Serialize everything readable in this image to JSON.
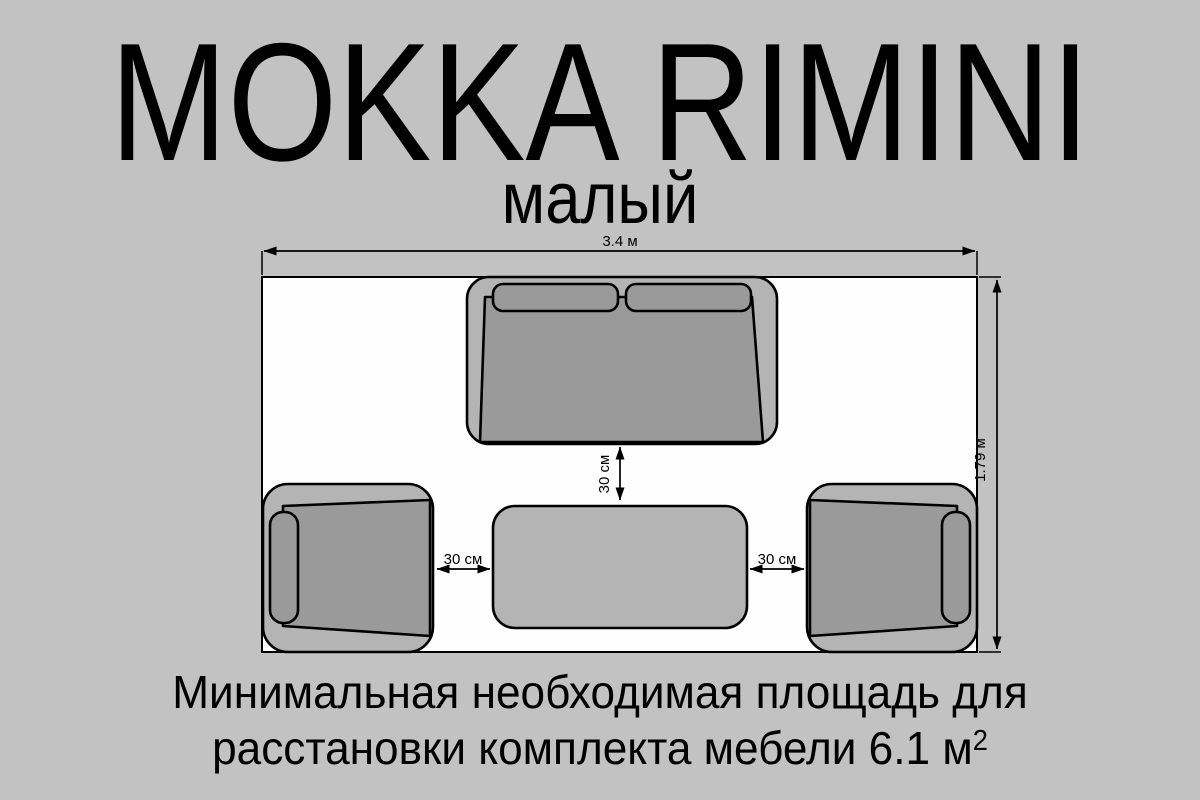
{
  "title": "MOKKA RIMINI",
  "subtitle": "малый",
  "diagram": {
    "dimensions": {
      "room_width_label": "3.4 м",
      "room_height_label": "1.79 м",
      "sofa_to_table_gap_label": "30 см",
      "left_chair_to_table_gap_label": "30 см",
      "table_to_right_chair_gap_label": "30 см"
    },
    "furniture": {
      "sofa": "двухместный диван",
      "left_armchair": "кресло",
      "right_armchair": "кресло",
      "coffee_table": "столик"
    }
  },
  "caption": {
    "line1": "Минимальная необходимая площадь для",
    "line2": "расстановки комплекта мебели 6.1 м",
    "superscript": "2"
  },
  "colors": {
    "page-bg": "#c2c2c2",
    "room-fill": "#fefefe",
    "furniture-light": "#b4b4b4",
    "furniture-dark": "#9a9a9a",
    "line-color": "#000000"
  }
}
